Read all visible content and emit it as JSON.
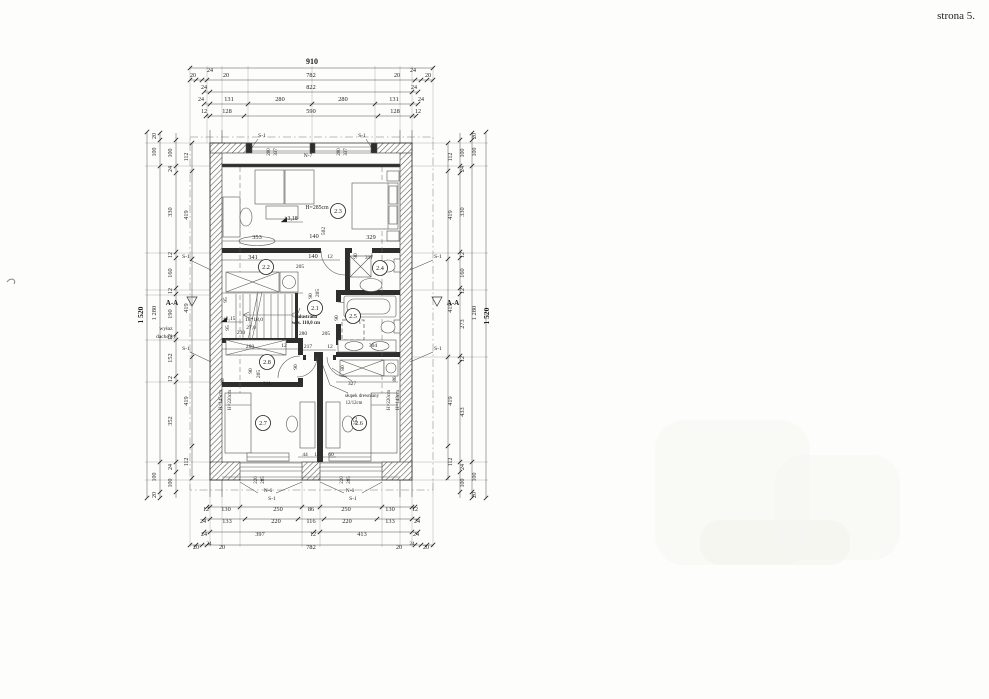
{
  "page": {
    "corner_note": "strona 5."
  },
  "colors": {
    "ink": "#1f1f1f",
    "wall_hatch": "#555555",
    "partition": "#2e2e2e",
    "paper": "#fdfdfb"
  },
  "plan": {
    "total_width": "910",
    "total_height": "1 520",
    "window_tag_top": "N-7",
    "window_tag_bottom": "N-6",
    "lintel_tag": "S-1",
    "section_mark": "A-A"
  },
  "rooms": [
    {
      "id": "2.3",
      "x": 338,
      "y": 211
    },
    {
      "id": "2.2",
      "x": 266,
      "y": 267
    },
    {
      "id": "2.4",
      "x": 380,
      "y": 268
    },
    {
      "id": "2.1",
      "x": 315,
      "y": 308
    },
    {
      "id": "2.5",
      "x": 353,
      "y": 316
    },
    {
      "id": "2.8",
      "x": 267,
      "y": 362
    },
    {
      "id": "2.7",
      "x": 263,
      "y": 423
    },
    {
      "id": "2.6",
      "x": 359,
      "y": 423
    }
  ],
  "labels": [
    {
      "t": "910",
      "x": 312,
      "y": 64,
      "b": 1,
      "s": 8
    },
    {
      "t": "20",
      "x": 193,
      "y": 77,
      "s": 6
    },
    {
      "t": "24",
      "x": 210,
      "y": 72,
      "s": 6
    },
    {
      "t": "20",
      "x": 226,
      "y": 77,
      "s": 6
    },
    {
      "t": "782",
      "x": 311,
      "y": 77
    },
    {
      "t": "20",
      "x": 397,
      "y": 77,
      "s": 6
    },
    {
      "t": "24",
      "x": 413,
      "y": 72,
      "s": 6
    },
    {
      "t": "20",
      "x": 428,
      "y": 77,
      "s": 6
    },
    {
      "t": "24",
      "x": 204,
      "y": 89,
      "s": 6
    },
    {
      "t": "822",
      "x": 311,
      "y": 89
    },
    {
      "t": "24",
      "x": 414,
      "y": 89,
      "s": 6
    },
    {
      "t": "24",
      "x": 201,
      "y": 101,
      "s": 6
    },
    {
      "t": "131",
      "x": 229,
      "y": 101
    },
    {
      "t": "280",
      "x": 280,
      "y": 101
    },
    {
      "t": "280",
      "x": 343,
      "y": 101
    },
    {
      "t": "131",
      "x": 394,
      "y": 101
    },
    {
      "t": "24",
      "x": 421,
      "y": 101,
      "s": 6
    },
    {
      "t": "12",
      "x": 204,
      "y": 113,
      "s": 6
    },
    {
      "t": "128",
      "x": 227,
      "y": 113
    },
    {
      "t": "590",
      "x": 311,
      "y": 113
    },
    {
      "t": "128",
      "x": 395,
      "y": 113
    },
    {
      "t": "12",
      "x": 418,
      "y": 113,
      "s": 6
    },
    {
      "t": "S-1",
      "x": 262,
      "y": 137,
      "s": 5.5
    },
    {
      "t": "S-1",
      "x": 362,
      "y": 137,
      "s": 5.5
    },
    {
      "t": "280",
      "x": 270,
      "y": 152,
      "r": 1,
      "s": 5
    },
    {
      "t": "337",
      "x": 277,
      "y": 152,
      "r": 1,
      "s": 5
    },
    {
      "t": "280",
      "x": 340,
      "y": 152,
      "r": 1,
      "s": 5
    },
    {
      "t": "337",
      "x": 347,
      "y": 152,
      "r": 1,
      "s": 5
    },
    {
      "t": "N-7",
      "x": 308,
      "y": 157,
      "s": 5.5
    },
    {
      "t": "1 520",
      "x": 143,
      "y": 315,
      "r": 1,
      "b": 1,
      "s": 7.5
    },
    {
      "t": "1 280",
      "x": 156,
      "y": 313,
      "r": 1,
      "s": 6.5
    },
    {
      "t": "20",
      "x": 156,
      "y": 136,
      "r": 1,
      "s": 6
    },
    {
      "t": "100",
      "x": 156,
      "y": 152,
      "r": 1,
      "s": 6
    },
    {
      "t": "100",
      "x": 156,
      "y": 477,
      "r": 1,
      "s": 6
    },
    {
      "t": "20",
      "x": 156,
      "y": 495,
      "r": 1,
      "s": 6
    },
    {
      "t": "100",
      "x": 172,
      "y": 153,
      "r": 1,
      "s": 6
    },
    {
      "t": "24",
      "x": 172,
      "y": 169,
      "r": 1,
      "s": 6
    },
    {
      "t": "330",
      "x": 172,
      "y": 212,
      "r": 1
    },
    {
      "t": "12",
      "x": 172,
      "y": 255,
      "r": 1,
      "s": 6
    },
    {
      "t": "160",
      "x": 172,
      "y": 273,
      "r": 1
    },
    {
      "t": "12",
      "x": 172,
      "y": 291,
      "r": 1,
      "s": 6
    },
    {
      "t": "190",
      "x": 172,
      "y": 314,
      "r": 1
    },
    {
      "t": "12",
      "x": 172,
      "y": 337,
      "r": 1,
      "s": 6
    },
    {
      "t": "152",
      "x": 172,
      "y": 358,
      "r": 1
    },
    {
      "t": "12",
      "x": 172,
      "y": 379,
      "r": 1,
      "s": 6
    },
    {
      "t": "352",
      "x": 172,
      "y": 421,
      "r": 1
    },
    {
      "t": "24",
      "x": 172,
      "y": 467,
      "r": 1,
      "s": 6
    },
    {
      "t": "100",
      "x": 172,
      "y": 483,
      "r": 1,
      "s": 6
    },
    {
      "t": "112",
      "x": 188,
      "y": 157,
      "r": 1,
      "s": 6
    },
    {
      "t": "419",
      "x": 188,
      "y": 215,
      "r": 1
    },
    {
      "t": "419",
      "x": 188,
      "y": 308,
      "r": 1
    },
    {
      "t": "419",
      "x": 188,
      "y": 401,
      "r": 1
    },
    {
      "t": "112",
      "x": 188,
      "y": 462,
      "r": 1,
      "s": 6
    },
    {
      "t": "A-A",
      "x": 172,
      "y": 305,
      "s": 7,
      "b": 1
    },
    {
      "t": "wyłaz",
      "x": 166,
      "y": 330,
      "s": 5.5
    },
    {
      "t": "dachowy",
      "x": 166,
      "y": 338,
      "s": 5.5
    },
    {
      "t": "S-1",
      "x": 186,
      "y": 258,
      "s": 5.5
    },
    {
      "t": "S-1",
      "x": 186,
      "y": 350,
      "s": 5.5
    },
    {
      "t": "S-1",
      "x": 438,
      "y": 258,
      "s": 5.5
    },
    {
      "t": "S-1",
      "x": 438,
      "y": 350,
      "s": 5.5
    },
    {
      "t": "A-A",
      "x": 453,
      "y": 305,
      "s": 7,
      "b": 1
    },
    {
      "t": "112",
      "x": 452,
      "y": 157,
      "r": 1,
      "s": 6
    },
    {
      "t": "419",
      "x": 452,
      "y": 215,
      "r": 1
    },
    {
      "t": "419",
      "x": 452,
      "y": 308,
      "r": 1
    },
    {
      "t": "419",
      "x": 452,
      "y": 401,
      "r": 1
    },
    {
      "t": "112",
      "x": 452,
      "y": 462,
      "r": 1,
      "s": 6
    },
    {
      "t": "100",
      "x": 464,
      "y": 153,
      "r": 1,
      "s": 6
    },
    {
      "t": "24",
      "x": 464,
      "y": 169,
      "r": 1,
      "s": 6
    },
    {
      "t": "330",
      "x": 464,
      "y": 212,
      "r": 1
    },
    {
      "t": "12",
      "x": 464,
      "y": 255,
      "r": 1,
      "s": 6
    },
    {
      "t": "160",
      "x": 464,
      "y": 273,
      "r": 1
    },
    {
      "t": "12",
      "x": 464,
      "y": 291,
      "r": 1,
      "s": 6
    },
    {
      "t": "273",
      "x": 464,
      "y": 324,
      "r": 1
    },
    {
      "t": "12",
      "x": 464,
      "y": 359,
      "r": 1,
      "s": 6
    },
    {
      "t": "433",
      "x": 464,
      "y": 412,
      "r": 1
    },
    {
      "t": "24",
      "x": 464,
      "y": 467,
      "r": 1,
      "s": 6
    },
    {
      "t": "100",
      "x": 464,
      "y": 483,
      "r": 1,
      "s": 6
    },
    {
      "t": "20",
      "x": 476,
      "y": 136,
      "r": 1,
      "s": 6
    },
    {
      "t": "100",
      "x": 476,
      "y": 152,
      "r": 1,
      "s": 6
    },
    {
      "t": "1 280",
      "x": 476,
      "y": 313,
      "r": 1,
      "s": 6.5
    },
    {
      "t": "100",
      "x": 476,
      "y": 477,
      "r": 1,
      "s": 6
    },
    {
      "t": "20",
      "x": 476,
      "y": 495,
      "r": 1,
      "s": 6
    },
    {
      "t": "1 520",
      "x": 489,
      "y": 316,
      "r": 1,
      "b": 1,
      "s": 7.5
    },
    {
      "t": "220",
      "x": 257,
      "y": 480,
      "r": 1,
      "s": 5
    },
    {
      "t": "285",
      "x": 264,
      "y": 480,
      "r": 1,
      "s": 5
    },
    {
      "t": "220",
      "x": 343,
      "y": 480,
      "r": 1,
      "s": 5
    },
    {
      "t": "285",
      "x": 350,
      "y": 480,
      "r": 1,
      "s": 5
    },
    {
      "t": "N-6",
      "x": 268,
      "y": 492,
      "s": 5.5
    },
    {
      "t": "N-6",
      "x": 350,
      "y": 492,
      "s": 5.5
    },
    {
      "t": "S-1",
      "x": 272,
      "y": 500,
      "s": 5.5
    },
    {
      "t": "S-1",
      "x": 353,
      "y": 500,
      "s": 5.5
    },
    {
      "t": "12",
      "x": 206,
      "y": 511,
      "s": 6
    },
    {
      "t": "130",
      "x": 226,
      "y": 511
    },
    {
      "t": "250",
      "x": 278,
      "y": 511
    },
    {
      "t": "86",
      "x": 311,
      "y": 511
    },
    {
      "t": "250",
      "x": 346,
      "y": 511
    },
    {
      "t": "130",
      "x": 390,
      "y": 511
    },
    {
      "t": "12",
      "x": 415,
      "y": 511,
      "s": 6
    },
    {
      "t": "24",
      "x": 203,
      "y": 523,
      "s": 6
    },
    {
      "t": "133",
      "x": 227,
      "y": 523
    },
    {
      "t": "220",
      "x": 276,
      "y": 523
    },
    {
      "t": "116",
      "x": 311,
      "y": 523
    },
    {
      "t": "220",
      "x": 347,
      "y": 523
    },
    {
      "t": "133",
      "x": 390,
      "y": 523
    },
    {
      "t": "24",
      "x": 417,
      "y": 523,
      "s": 6
    },
    {
      "t": "24",
      "x": 204,
      "y": 536,
      "s": 6
    },
    {
      "t": "397",
      "x": 260,
      "y": 536
    },
    {
      "t": "12",
      "x": 313,
      "y": 536,
      "s": 6
    },
    {
      "t": "413",
      "x": 362,
      "y": 536
    },
    {
      "t": "24",
      "x": 416,
      "y": 536,
      "s": 6
    },
    {
      "t": "20",
      "x": 196,
      "y": 549,
      "s": 6
    },
    {
      "t": "24",
      "x": 209,
      "y": 545,
      "s": 5
    },
    {
      "t": "20",
      "x": 222,
      "y": 549,
      "s": 6
    },
    {
      "t": "782",
      "x": 311,
      "y": 549
    },
    {
      "t": "20",
      "x": 399,
      "y": 549,
      "s": 6
    },
    {
      "t": "24",
      "x": 412,
      "y": 545,
      "s": 5
    },
    {
      "t": "20",
      "x": 426,
      "y": 549,
      "s": 6
    },
    {
      "t": "H=285cm",
      "x": 317,
      "y": 209,
      "s": 5.8
    },
    {
      "t": "+3,18",
      "x": 291,
      "y": 220,
      "s": 5.8
    },
    {
      "t": "353",
      "x": 257,
      "y": 239
    },
    {
      "t": "140",
      "x": 314,
      "y": 238
    },
    {
      "t": "502",
      "x": 325,
      "y": 231,
      "r": 1,
      "s": 5.5
    },
    {
      "t": "329",
      "x": 371,
      "y": 239
    },
    {
      "t": "341",
      "x": 253,
      "y": 259
    },
    {
      "t": "140",
      "x": 313,
      "y": 258
    },
    {
      "t": "12",
      "x": 330,
      "y": 258,
      "s": 5.5
    },
    {
      "t": "205",
      "x": 300,
      "y": 268,
      "s": 5.5
    },
    {
      "t": "90",
      "x": 357,
      "y": 256,
      "r": 1,
      "s": 5.5
    },
    {
      "t": "317",
      "x": 369,
      "y": 259,
      "s": 5.5
    },
    {
      "t": "+2,15",
      "x": 229,
      "y": 320,
      "s": 5.5
    },
    {
      "t": "18*18,0",
      "x": 254,
      "y": 321,
      "s": 5.5
    },
    {
      "t": "27,0",
      "x": 251,
      "y": 329,
      "s": 5.5
    },
    {
      "t": "230",
      "x": 241,
      "y": 334,
      "s": 5.5
    },
    {
      "t": "95",
      "x": 227,
      "y": 300,
      "r": 1,
      "s": 5.5
    },
    {
      "t": "95",
      "x": 229,
      "y": 328,
      "r": 1,
      "s": 5.5
    },
    {
      "t": "balustrada",
      "x": 306,
      "y": 318,
      "s": 4.8,
      "b": 1
    },
    {
      "t": "wys. 110,0 cm",
      "x": 306,
      "y": 324,
      "s": 4.8,
      "b": 1
    },
    {
      "t": "90",
      "x": 312,
      "y": 296,
      "r": 1,
      "s": 5.5
    },
    {
      "t": "205",
      "x": 319,
      "y": 293,
      "r": 1,
      "s": 5.5
    },
    {
      "t": "280",
      "x": 303,
      "y": 335,
      "s": 5.5
    },
    {
      "t": "205",
      "x": 326,
      "y": 335,
      "s": 5.5
    },
    {
      "t": "90",
      "x": 338,
      "y": 318,
      "r": 1,
      "s": 5.5
    },
    {
      "t": "217",
      "x": 308,
      "y": 348,
      "s": 5.5
    },
    {
      "t": "12",
      "x": 330,
      "y": 348,
      "s": 5.5
    },
    {
      "t": "304",
      "x": 373,
      "y": 347,
      "s": 5.5
    },
    {
      "t": "90",
      "x": 297,
      "y": 367,
      "r": 1,
      "s": 5.5
    },
    {
      "t": "80",
      "x": 344,
      "y": 368,
      "r": 1,
      "s": 5.5
    },
    {
      "t": "327",
      "x": 352,
      "y": 385,
      "s": 5.5
    },
    {
      "t": "słupek drewniany",
      "x": 362,
      "y": 397,
      "s": 4.8
    },
    {
      "t": "12/12cm",
      "x": 354,
      "y": 404,
      "s": 4.8
    },
    {
      "t": "280",
      "x": 250,
      "y": 348,
      "s": 5.5
    },
    {
      "t": "12",
      "x": 284,
      "y": 347,
      "s": 5.5
    },
    {
      "t": "90",
      "x": 252,
      "y": 371,
      "r": 1,
      "s": 5.5
    },
    {
      "t": "205",
      "x": 260,
      "y": 374,
      "r": 1,
      "s": 5.5
    },
    {
      "t": "311",
      "x": 267,
      "y": 385,
      "s": 5.5
    },
    {
      "t": "86",
      "x": 224,
      "y": 381,
      "r": 1,
      "s": 5
    },
    {
      "t": "H=145cm",
      "x": 222,
      "y": 400,
      "r": 1,
      "s": 5
    },
    {
      "t": "H=220cm",
      "x": 231,
      "y": 400,
      "r": 1,
      "s": 5
    },
    {
      "t": "H=220cm",
      "x": 390,
      "y": 400,
      "r": 1,
      "s": 5
    },
    {
      "t": "H=143cm",
      "x": 399,
      "y": 400,
      "r": 1,
      "s": 5
    },
    {
      "t": "86",
      "x": 396,
      "y": 379,
      "r": 1,
      "s": 5
    },
    {
      "t": "44",
      "x": 305,
      "y": 456,
      "s": 5.5
    },
    {
      "t": "12",
      "x": 317,
      "y": 456,
      "s": 5.5
    },
    {
      "t": "60",
      "x": 331,
      "y": 456,
      "s": 5.5
    },
    {
      "t": "352",
      "x": 357,
      "y": 421,
      "r": 1,
      "s": 5.5
    }
  ],
  "dims": {
    "h": [
      {
        "y": 68,
        "x1": 190,
        "x2": 433,
        "ticks": [
          190,
          433
        ]
      },
      {
        "y": 80,
        "x1": 190,
        "x2": 433,
        "ticks": [
          190,
          196,
          202,
          207,
          415,
          421,
          427,
          433
        ]
      },
      {
        "y": 92,
        "x1": 204,
        "x2": 418,
        "ticks": [
          204,
          210,
          412,
          418
        ]
      },
      {
        "y": 104,
        "x1": 204,
        "x2": 418,
        "ticks": [
          204,
          210,
          248,
          312,
          375,
          412,
          418
        ]
      },
      {
        "y": 116,
        "x1": 206,
        "x2": 416,
        "ticks": [
          206,
          210,
          244,
          378,
          412,
          416
        ]
      },
      {
        "y": 507,
        "x1": 207,
        "x2": 415,
        "ticks": [
          207,
          210,
          240,
          302,
          320,
          382,
          412,
          415
        ]
      },
      {
        "y": 519,
        "x1": 204,
        "x2": 418,
        "ticks": [
          204,
          210,
          245,
          298,
          324,
          377,
          412,
          418
        ]
      },
      {
        "y": 532,
        "x1": 204,
        "x2": 418,
        "ticks": [
          204,
          210,
          314,
          320,
          412,
          418
        ]
      },
      {
        "y": 545,
        "x1": 190,
        "x2": 433,
        "ticks": [
          190,
          196,
          202,
          207,
          415,
          421,
          427,
          433
        ]
      }
    ],
    "v": [
      {
        "x": 147,
        "y1": 132,
        "y2": 498,
        "ticks": [
          132,
          498
        ]
      },
      {
        "x": 160,
        "y1": 132,
        "y2": 498,
        "ticks": [
          133,
          140,
          166,
          462,
          492,
          498
        ]
      },
      {
        "x": 176,
        "y1": 133,
        "y2": 498,
        "ticks": [
          140,
          166,
          173,
          252,
          258,
          288,
          294,
          334,
          340,
          376,
          382,
          462,
          472,
          492
        ]
      },
      {
        "x": 192,
        "y1": 143,
        "y2": 480,
        "ticks": [
          143,
          171,
          259,
          357,
          446,
          478
        ]
      },
      {
        "x": 448,
        "y1": 143,
        "y2": 480,
        "ticks": [
          143,
          171,
          259,
          357,
          446,
          478
        ]
      },
      {
        "x": 460,
        "y1": 133,
        "y2": 498,
        "ticks": [
          140,
          166,
          173,
          252,
          258,
          288,
          294,
          356,
          362,
          462,
          472,
          492
        ]
      },
      {
        "x": 472,
        "y1": 132,
        "y2": 498,
        "ticks": [
          133,
          140,
          166,
          462,
          492,
          498
        ]
      },
      {
        "x": 486,
        "y1": 132,
        "y2": 498,
        "ticks": [
          132,
          498
        ]
      }
    ],
    "interior": [
      {
        "x1": 222,
        "y1": 241,
        "x2": 400,
        "y2": 241
      },
      {
        "x1": 222,
        "y1": 260,
        "x2": 340,
        "y2": 260
      },
      {
        "x1": 222,
        "y1": 349,
        "x2": 298,
        "y2": 349
      },
      {
        "x1": 222,
        "y1": 386,
        "x2": 303,
        "y2": 386
      },
      {
        "x1": 336,
        "y1": 382,
        "x2": 398,
        "y2": 382
      },
      {
        "x1": 298,
        "y1": 457,
        "x2": 336,
        "y2": 457
      },
      {
        "x1": 303,
        "y1": 350,
        "x2": 336,
        "y2": 350
      }
    ]
  }
}
